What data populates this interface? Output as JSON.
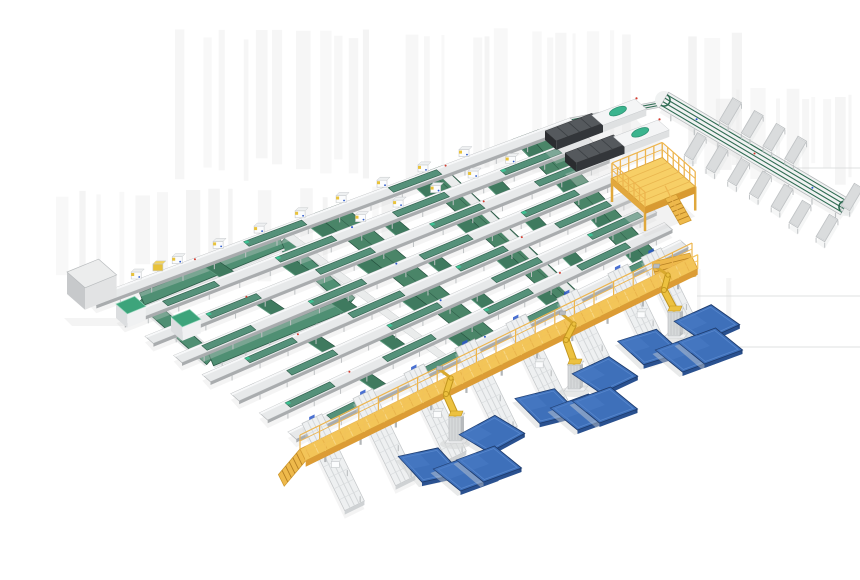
{
  "meta": {
    "description": "Isometric 3D render of an automated conveyor sorting and robotic palletizing line",
    "canvas": {
      "w": 860,
      "h": 580
    }
  },
  "palette": {
    "bg": "#ffffff",
    "streak": "#e9e9e9",
    "faint_line": "#d8d9da",
    "shadow": "#d9dadb",
    "frame": "#e7e9ea",
    "frame_hi": "#f7f8f9",
    "frame_edge": "#b6b9bb",
    "frame_under": "#a9acae",
    "leg": "#bfc2c4",
    "belt": "#55917a",
    "belt_dark": "#2c5c48",
    "cross": "#3f7a5f",
    "cross_edge": "#24503e",
    "cross_hi": "#6aa98c",
    "wide": "#4a8568",
    "ring": "#4f8f73",
    "mint": "#3cc293",
    "white_box": "#fbfcfd",
    "box_edge": "#c6c9cb",
    "box_top": "#eef0f1",
    "machine_top": "#55595d",
    "machine_front": "#33363a",
    "machine_side": "#2a2c2f",
    "machine_white": "#f4f5f6",
    "machine_white_side": "#dfe1e2",
    "oval": "#3bb48e",
    "oval_edge": "#2f9474",
    "red": "#d23b2f",
    "blue_dot": "#2a57c9",
    "yellow_deck": "#f3c558",
    "yellow_top": "#f7cf66",
    "yellow_rail": "#edb54e",
    "yellow_side": "#dc9c35",
    "yellow_deep": "#c98a2a",
    "slat": "#f8d98c",
    "slat2": "#e8b24a",
    "stair": "#eeb94b",
    "stair_edge": "#cf9a30",
    "robot": "#ecc13f",
    "robot_dark": "#c2961f",
    "robot_fore": "#d9a92e",
    "pedestal": "#d6d9da",
    "pedestal_side": "#b8bbbd",
    "base_plate": "#f2f3f4",
    "pallet_top": "#3e70ba",
    "pallet_hi": "#5c8bd0",
    "pallet_side": "#24477f",
    "pallet_front": "#2a5190",
    "pallet_edge": "#1e3c6e",
    "pallet_sheen": "#4a7cc6",
    "tray": "#f1f3f3",
    "tray_in": "#dadcdd",
    "tray_edge": "#bcbfc1",
    "spine_frame": "#f0f2f2",
    "spine_rail": "#2e6b52",
    "cab_top": "#eceded",
    "cab_front": "#e2e3e4",
    "cab_side": "#c7c9cb",
    "greencab": "#3da47b",
    "greencab_rim": "#8fd4b8",
    "cab_body": "#f0f1f2",
    "cab_body_side": "#dcdee0"
  },
  "scene": {
    "axes": {
      "A": [
        0.93,
        -0.38
      ],
      "B": [
        0.75,
        0.66
      ]
    },
    "streak_regions": [
      {
        "x0": 175,
        "x1": 758,
        "y0": 28,
        "y1": 186,
        "seed": 7
      },
      {
        "x0": 56,
        "x1": 392,
        "y0": 186,
        "y1": 290,
        "seed": 13
      },
      {
        "x0": 697,
        "x1": 745,
        "y0": 266,
        "y1": 352,
        "seed": 21
      },
      {
        "x0": 700,
        "x1": 858,
        "y0": 88,
        "y1": 190,
        "seed": 29
      }
    ],
    "faint_lines": [
      [
        788,
        168,
        860
      ],
      [
        697,
        296,
        860
      ],
      [
        724,
        347,
        860
      ]
    ],
    "grid": {
      "lanes": 8,
      "top_edge": {
        "from": [
          88,
          298
        ],
        "to": [
          570,
          118
        ]
      },
      "bottom_edge": {
        "from": [
          288,
          432
        ],
        "to": [
          680,
          240
        ]
      },
      "lane_width": 11,
      "belt_ranges": [
        [
          0.06,
          0.17
        ],
        [
          0.3,
          0.42
        ],
        [
          0.55,
          0.66
        ],
        [
          0.78,
          0.9
        ]
      ],
      "lane0_belt_ranges": [
        [
          0.32,
          0.44
        ],
        [
          0.62,
          0.72
        ]
      ],
      "cross_ts": [
        0.22,
        0.33,
        0.44,
        0.55,
        0.66,
        0.77,
        0.88
      ],
      "wide_ts": [
        0.47,
        0.68,
        0.88
      ],
      "extension": {
        "from": [
          570,
          118
        ],
        "to": [
          664,
          100
        ]
      }
    },
    "shuttles": {
      "lane0_ts": [
        0.1,
        0.185,
        0.27,
        0.355,
        0.44,
        0.525,
        0.61,
        0.695,
        0.78
      ],
      "lane1_ts": [
        0.52,
        0.6,
        0.68,
        0.76,
        0.84
      ],
      "yellow_t": 0.145
    },
    "ring": {
      "origin": [
        142,
        299
      ],
      "a_len": 150,
      "b_len": 92,
      "width": 13
    },
    "cabinets": {
      "gray": {
        "origin": [
          67,
          294
        ],
        "a": 34,
        "b": 24,
        "h": 22
      },
      "green": [
        {
          "origin": [
            116,
            318
          ],
          "a": 20,
          "b": 15,
          "h": 14
        },
        {
          "origin": [
            171,
            331
          ],
          "a": 20,
          "b": 15,
          "h": 14
        }
      ]
    },
    "machines": [
      {
        "from": [
          545,
          140
        ],
        "to": [
          635,
          106
        ]
      },
      {
        "from": [
          565,
          162
        ],
        "to": [
          658,
          127
        ]
      }
    ],
    "spine": {
      "from": [
        664,
        100
      ],
      "to": [
        845,
        207
      ],
      "rail_offsets": [
        -6,
        -2,
        2,
        6
      ],
      "tray_out_ts": [
        0.3,
        0.42,
        0.54,
        0.66
      ],
      "tray_in_ts": [
        0.24,
        0.36,
        0.48,
        0.6,
        0.72
      ],
      "extra_trays": [
        [
          800,
          214
        ],
        [
          827,
          228
        ],
        [
          852,
          197
        ]
      ]
    },
    "platform": {
      "origin": [
        612,
        202
      ],
      "a_len": 54,
      "b_len": 44,
      "height": 24
    },
    "catwalk": {
      "from": [
        300,
        449
      ],
      "to": [
        692,
        257
      ],
      "width": 13
    },
    "spurs": {
      "ts": [
        0.055,
        0.185,
        0.315,
        0.445,
        0.575,
        0.705,
        0.835,
        0.92
      ],
      "len": 75,
      "back": 22,
      "halfw": 11
    },
    "robots": [
      {
        "base": [
          455,
          441
        ],
        "pose": [
          [
            -9,
            -20
          ],
          [
            -4,
            -36
          ],
          [
            -16,
            -45
          ]
        ]
      },
      {
        "base": [
          574,
          389
        ],
        "pose": [
          [
            -8,
            -22
          ],
          [
            0,
            -38
          ],
          [
            -12,
            -48
          ]
        ]
      },
      {
        "base": [
          674,
          336
        ],
        "pose": [
          [
            -10,
            -19
          ],
          [
            -6,
            -34
          ],
          [
            -18,
            -42
          ]
        ]
      }
    ],
    "pallets": [
      [
        707,
        323,
        -4
      ],
      [
        650,
        347,
        3
      ],
      [
        688,
        354,
        0
      ],
      [
        710,
        346,
        0
      ],
      [
        605,
        375,
        -5
      ],
      [
        547,
        406,
        6
      ],
      [
        583,
        412,
        0
      ],
      [
        605,
        405,
        0
      ],
      [
        492,
        434,
        -8
      ],
      [
        430,
        465,
        8
      ],
      [
        466,
        473,
        0
      ],
      [
        489,
        464,
        0
      ]
    ]
  }
}
